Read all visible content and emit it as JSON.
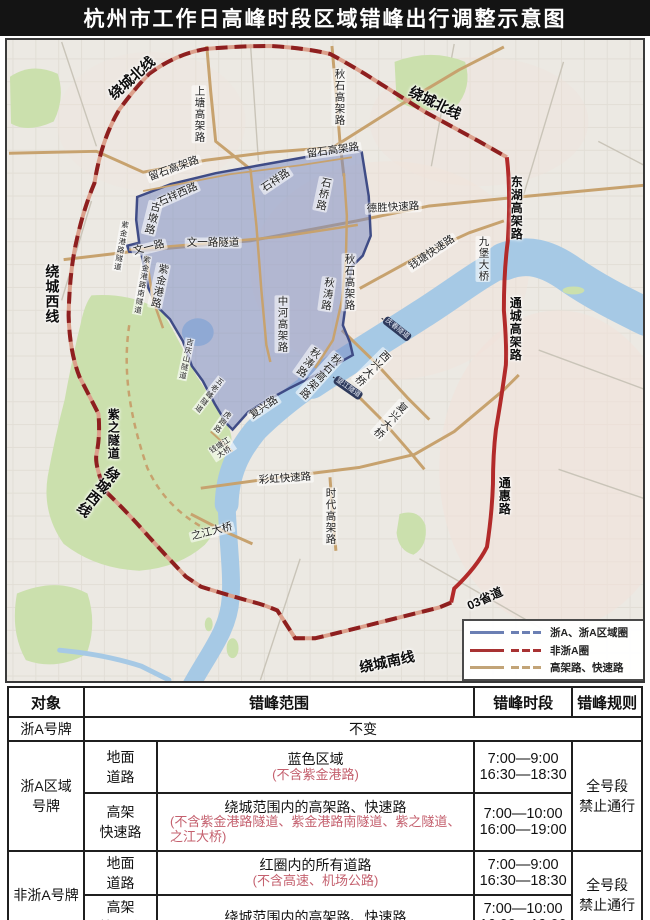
{
  "title": "杭州市工作日高峰时段区域错峰出行调整示意图",
  "colors": {
    "title_bg": "#141414",
    "zone_fill": "#7b8cc3",
    "zone_border": "#3f4c86",
    "ring_red_dash": "#8e1f1f",
    "solid_red": "#b22a2a",
    "road_tan": "#c7a26e",
    "water_blue": "#a6c9e5",
    "green_area": "#cbe0ad",
    "note_red": "#c4606e",
    "legend_blue": "#6b7fb3",
    "legend_red": "#a83232",
    "legend_tan": "#c2a477"
  },
  "map": {
    "legend": {
      "items": [
        {
          "label": "浙A、浙A区域圈",
          "color": "#6b7fb3"
        },
        {
          "label": "非浙A圈",
          "color": "#a83232"
        },
        {
          "label": "高架路、快速路",
          "color": "#c2a477"
        }
      ]
    },
    "labels": [
      {
        "text": "绕城北线",
        "x": 130,
        "y": 76,
        "rot": -42,
        "cls": "ring"
      },
      {
        "text": "绕城北线",
        "x": 433,
        "y": 101,
        "rot": 26,
        "cls": "ring"
      },
      {
        "text": "绕城西线",
        "x": 50,
        "y": 292,
        "rot": 0,
        "cls": "ring v"
      },
      {
        "text": "绕城西线",
        "x": 96,
        "y": 490,
        "rot": 38,
        "cls": "ring v"
      },
      {
        "text": "绕城南线",
        "x": 385,
        "y": 660,
        "rot": -12,
        "cls": "ring"
      },
      {
        "text": "紫之隧道",
        "x": 111,
        "y": 432,
        "rot": 0,
        "cls": "ring v",
        "size": 12
      },
      {
        "text": "东湖高架路",
        "x": 514,
        "y": 206,
        "rot": 0,
        "cls": "ring v",
        "size": 12
      },
      {
        "text": "通城高架路",
        "x": 513,
        "y": 327,
        "rot": 0,
        "cls": "ring v",
        "size": 12
      },
      {
        "text": "通惠路",
        "x": 502,
        "y": 494,
        "rot": 0,
        "cls": "ring v",
        "size": 12
      },
      {
        "text": "03省道",
        "x": 483,
        "y": 597,
        "rot": -24,
        "cls": "ring",
        "size": 12
      },
      {
        "text": "上塘高架路",
        "x": 197,
        "y": 112,
        "rot": 0,
        "cls": "road v"
      },
      {
        "text": "秋石高架路",
        "x": 337,
        "y": 95,
        "rot": 0,
        "cls": "road v"
      },
      {
        "text": "留石高架路",
        "x": 172,
        "y": 167,
        "rot": -20,
        "cls": "road"
      },
      {
        "text": "留石高架路",
        "x": 331,
        "y": 149,
        "rot": -8,
        "cls": "road"
      },
      {
        "text": "石祥西路",
        "x": 176,
        "y": 193,
        "rot": -24,
        "cls": "road"
      },
      {
        "text": "石祥路",
        "x": 274,
        "y": 179,
        "rot": -34,
        "cls": "road"
      },
      {
        "text": "石桥路",
        "x": 321,
        "y": 192,
        "rot": 12,
        "cls": "road v"
      },
      {
        "text": "古墩路",
        "x": 150,
        "y": 216,
        "rot": 14,
        "cls": "road v"
      },
      {
        "text": "文一路",
        "x": 147,
        "y": 246,
        "rot": -14,
        "cls": "road"
      },
      {
        "text": "文一路隧道",
        "x": 211,
        "y": 241,
        "rot": 0,
        "cls": "road"
      },
      {
        "text": "紫金港路",
        "x": 157,
        "y": 284,
        "rot": 12,
        "cls": "road v"
      },
      {
        "text": "德胜快速路",
        "x": 391,
        "y": 206,
        "rot": -3,
        "cls": "road"
      },
      {
        "text": "钱塘快速路",
        "x": 430,
        "y": 251,
        "rot": -34,
        "cls": "road"
      },
      {
        "text": "九堡大桥",
        "x": 481,
        "y": 257,
        "rot": 0,
        "cls": "road v"
      },
      {
        "text": "秋涛路",
        "x": 325,
        "y": 292,
        "rot": 8,
        "cls": "road v"
      },
      {
        "text": "秋石高架路",
        "x": 347,
        "y": 280,
        "rot": 0,
        "cls": "road v"
      },
      {
        "text": "中河高架路",
        "x": 280,
        "y": 322,
        "rot": 0,
        "cls": "road v"
      },
      {
        "text": "秋涛路",
        "x": 306,
        "y": 360,
        "rot": 35,
        "cls": "road v"
      },
      {
        "text": "秋石高架路",
        "x": 318,
        "y": 374,
        "rot": 42,
        "cls": "road v"
      },
      {
        "text": "复兴路",
        "x": 262,
        "y": 406,
        "rot": -34,
        "cls": "road"
      },
      {
        "text": "复兴大桥",
        "x": 388,
        "y": 418,
        "rot": 42,
        "cls": "road v"
      },
      {
        "text": "西兴大桥",
        "x": 370,
        "y": 366,
        "rot": 45,
        "cls": "road v"
      },
      {
        "text": "彩虹快速路",
        "x": 283,
        "y": 477,
        "rot": -4,
        "cls": "road"
      },
      {
        "text": "时代高架路",
        "x": 328,
        "y": 514,
        "rot": 0,
        "cls": "road v"
      },
      {
        "text": "之江大桥",
        "x": 210,
        "y": 530,
        "rot": -14,
        "cls": "road"
      },
      {
        "text": "钱塘江\n大桥",
        "x": 220,
        "y": 447,
        "rot": -33,
        "cls": "sm pre"
      },
      {
        "text": "紫金港路隧道",
        "x": 119,
        "y": 244,
        "rot": 10,
        "cls": "sm v"
      },
      {
        "text": "紫金港路南隧道",
        "x": 140,
        "y": 283,
        "rot": 10,
        "cls": "sm v"
      },
      {
        "text": "吉庆山隧道",
        "x": 184,
        "y": 357,
        "rot": 12,
        "cls": "sm v"
      },
      {
        "text": "五老峰隧道",
        "x": 207,
        "y": 393,
        "rot": 38,
        "cls": "sm v"
      },
      {
        "text": "虎跑路",
        "x": 220,
        "y": 420,
        "rot": 35,
        "cls": "sm v"
      },
      {
        "text": "庆春隧道",
        "x": 395,
        "y": 327,
        "rot": 38,
        "cls": "tunnel"
      },
      {
        "text": "望江隧道",
        "x": 346,
        "y": 386,
        "rot": 35,
        "cls": "tunnel"
      }
    ]
  },
  "table": {
    "headers": [
      "对象",
      "错峰范围",
      "错峰时段",
      "错峰规则"
    ],
    "row_zhea": {
      "plate": "浙A号牌",
      "scope": "不变"
    },
    "row_area": {
      "plate": "浙A区域\n号牌",
      "rule": "全号段\n禁止通行",
      "sub": [
        {
          "type": "地面\n道路",
          "scope": "蓝色区域",
          "note": "(不含紫金港路)",
          "time": "7:00—9:00\n16:30—18:30"
        },
        {
          "type": "高架\n快速路",
          "scope": "绕城范围内的高架路、快速路",
          "note": "(不含紫金港路隧道、紫金港路南隧道、紫之隧道、之江大桥)",
          "time": "7:00—10:00\n16:00—19:00"
        }
      ]
    },
    "row_nonzhea": {
      "plate": "非浙A号牌",
      "rule": "全号段\n禁止通行",
      "sub": [
        {
          "type": "地面\n道路",
          "scope": "红圈内的所有道路",
          "note": "(不含高速、机场公路)",
          "time": "7:00—9:00\n16:30—18:30"
        },
        {
          "type": "高架\n快速路",
          "scope": "绕城范围内的高架路、快速路",
          "note": "",
          "time": "7:00—10:00\n16:00—19:00"
        }
      ]
    }
  }
}
